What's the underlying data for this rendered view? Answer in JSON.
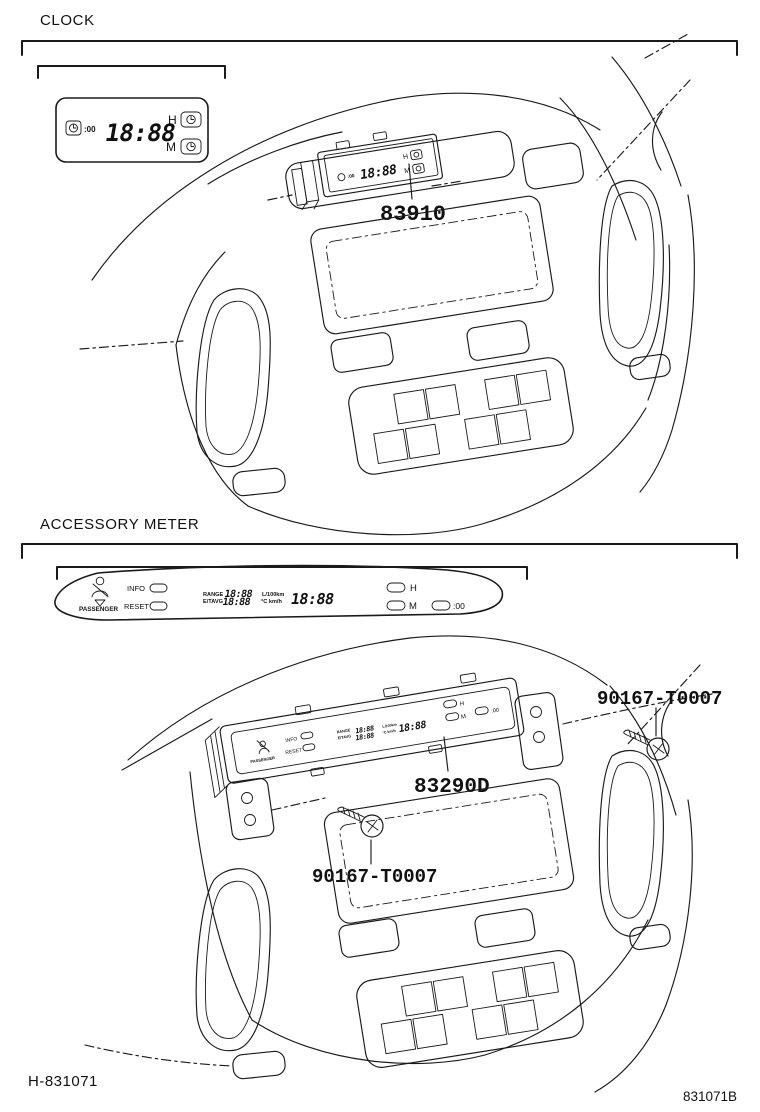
{
  "colors": {
    "line": "#1a1a1a",
    "background": "#ffffff",
    "text": "#111111"
  },
  "clock_section": {
    "title": "CLOCK",
    "part_number": "83910",
    "display": {
      "set_button": ":00",
      "time": "18:88",
      "hour": "H",
      "minute": "M"
    }
  },
  "accessory_section": {
    "title": "ACCESSORY METER",
    "part_number": "83290D",
    "screw_labels": {
      "left": "90167-T0007",
      "right": "90167-T0007"
    },
    "display": {
      "passenger": "PASSENGER",
      "info": "INFO",
      "reset": "RESET",
      "range": "RANGE",
      "etavg": "E/TAVG",
      "value_top": "18:88",
      "value_bottom": "18:88",
      "unit_top": "L/100km",
      "unit_bottom": "°C km/h",
      "clock_value": "18:88",
      "hour": "H",
      "minute": "M",
      "set_button": ":00"
    }
  },
  "footer": {
    "left": "H-831071",
    "right": "831071B"
  }
}
